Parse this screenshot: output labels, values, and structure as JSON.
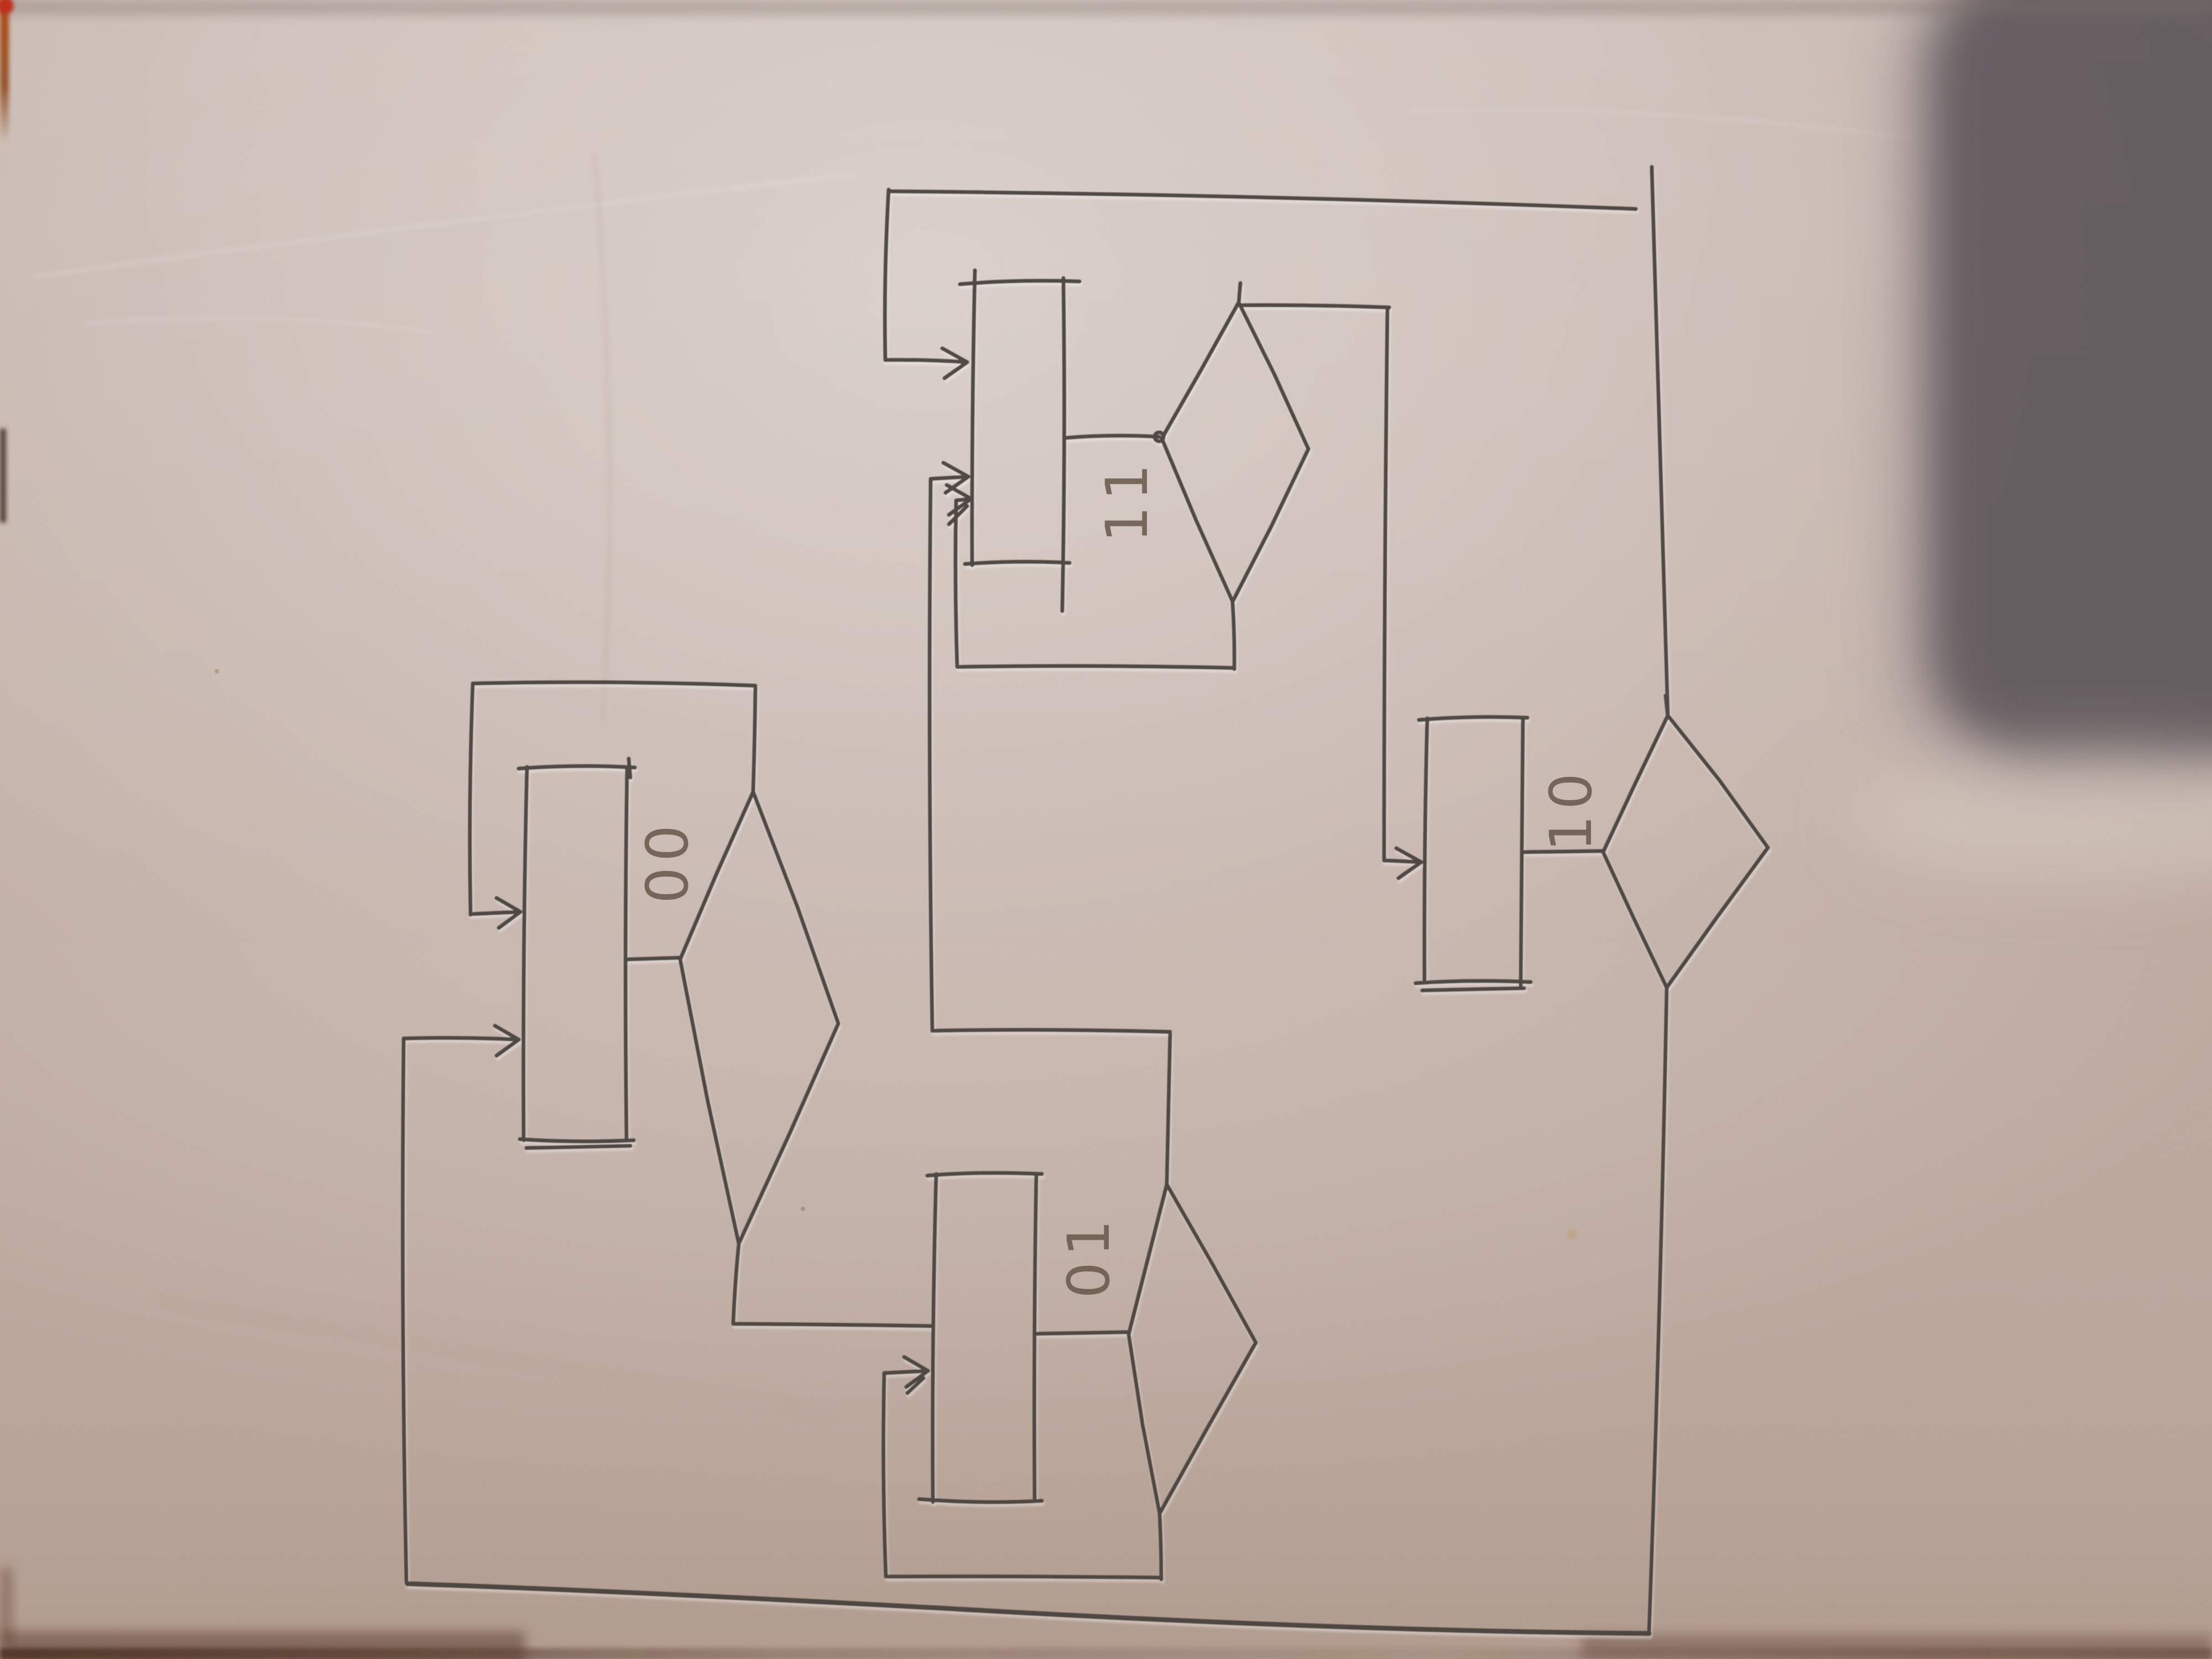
{
  "meta": {
    "kind": "photograph of a hand-drawn state-machine flowchart on paper",
    "orientation_note": "state labels are written rotated 90° counter-clockwise (read bottom-to-top)"
  },
  "colors": {
    "paper": "#cdbeb7",
    "paper_highlight": "#dcd2cc",
    "paper_shadow": "#ab9788",
    "ink": "#4a423c",
    "label_ink": "#635246",
    "dark_object_shadow": "#645c5f",
    "table_edge_dark": "#4a2f22",
    "left_edge_orange": "#b24a17",
    "corner_red_dot": "#bf2d1a"
  },
  "diagram": {
    "type": "state-diagram",
    "states": [
      {
        "id": "00",
        "label": "00",
        "shape": "rectangle + decision diamond"
      },
      {
        "id": "01",
        "label": "01",
        "shape": "rectangle + decision diamond"
      },
      {
        "id": "10",
        "label": "10",
        "shape": "rectangle + decision diamond"
      },
      {
        "id": "11",
        "label": "11",
        "shape": "rectangle + decision diamond"
      }
    ],
    "transitions": [
      {
        "from": "00",
        "to": "00",
        "kind": "self-loop",
        "route": "diamond top → up → left → down → arrow into box"
      },
      {
        "from": "00",
        "to": "01",
        "kind": "cross",
        "route": "diamond bottom → down → right into box edge"
      },
      {
        "from": "01",
        "to": "01",
        "kind": "self-loop",
        "route": "diamond bottom → down → left → up → arrow into box"
      },
      {
        "from": "01",
        "to": "11",
        "kind": "cross",
        "route": "diamond top → up → left → up → arrow into box"
      },
      {
        "from": "11",
        "to": "11",
        "kind": "self-loop",
        "route": "diamond bottom → down → left → up → arrow into box"
      },
      {
        "from": "11",
        "to": "10",
        "kind": "cross",
        "route": "diamond top → right → down → arrow into box"
      },
      {
        "from": "10",
        "to": "11",
        "kind": "cross",
        "route": "diamond top → up → left along page top → down → arrow into box"
      },
      {
        "from": "10",
        "to": "00",
        "kind": "cross",
        "route": "diamond bottom → down → left along page bottom → up → arrow into box"
      }
    ]
  }
}
